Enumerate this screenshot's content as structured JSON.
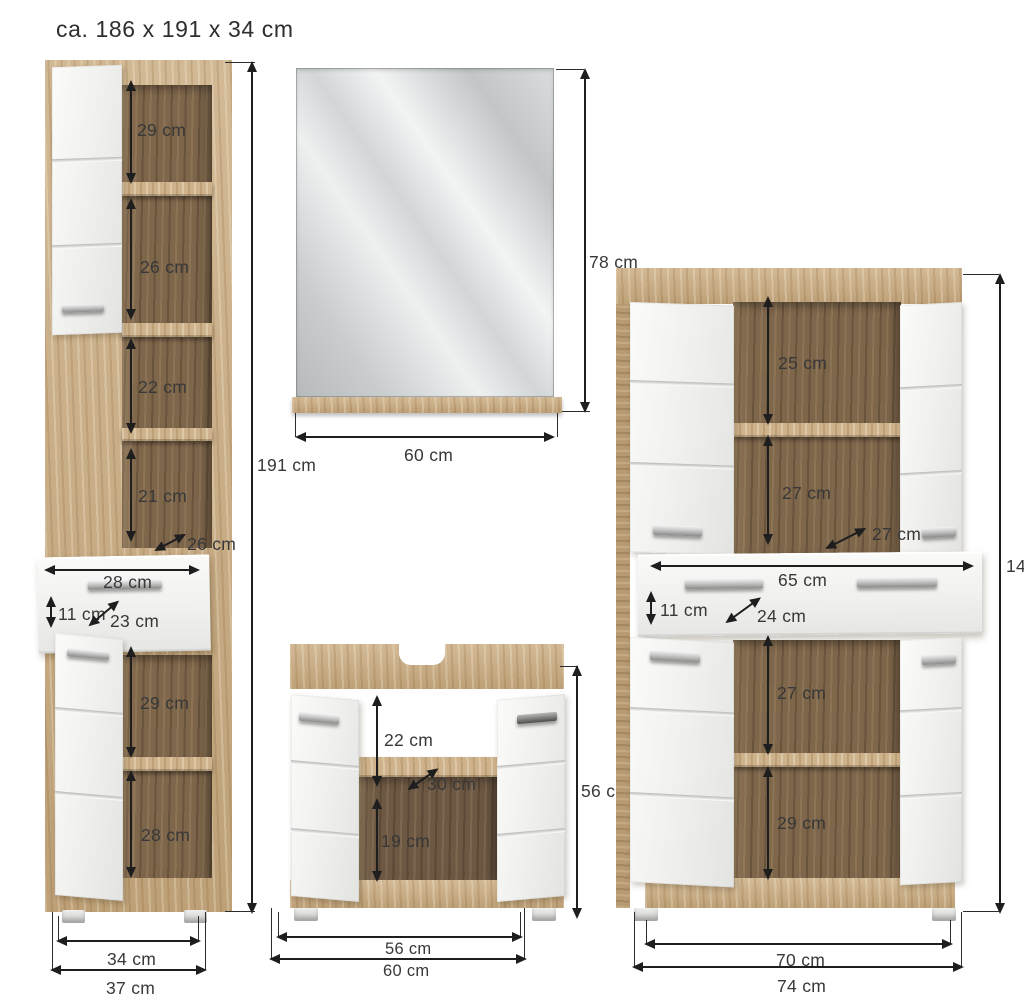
{
  "title": "ca. 186 x 191 x 34 cm",
  "colors": {
    "wood_light": "#cbae84",
    "wood_interior": "#7e664b",
    "front_white": "#f1f1ef",
    "mirror_glass": "#d2d6d7",
    "dimension_line": "#1e1e1e",
    "label_text": "#383838",
    "background": "#ffffff"
  },
  "tall_cabinet": {
    "height": "191 cm",
    "compartments": {
      "c1": "29 cm",
      "c2": "26 cm",
      "c3": "22 cm",
      "c4": "21 cm"
    },
    "depth": "26 cm",
    "drawer": {
      "width": "28 cm",
      "height": "11 cm",
      "depth": "23 cm"
    },
    "lower_compartments": {
      "c1": "29 cm",
      "c2": "28 cm"
    },
    "width_inner": "34 cm",
    "width_outer": "37 cm"
  },
  "mirror": {
    "height": "78 cm",
    "width": "60 cm"
  },
  "sink_cabinet": {
    "upper_compartment": "22 cm",
    "depth": "30 cm",
    "lower_compartment": "19 cm",
    "height": "56 cm",
    "width_inner": "56 cm",
    "width_outer": "60 cm"
  },
  "right_cabinet": {
    "height": "141",
    "compartments": {
      "c1": "25 cm",
      "c2": "27 cm"
    },
    "depth": "27 cm",
    "drawer": {
      "width": "65 cm",
      "height": "11 cm",
      "depth": "24 cm"
    },
    "lower_compartments": {
      "c1": "27 cm",
      "c2": "29 cm"
    },
    "width_inner": "70 cm",
    "width_outer": "74 cm"
  }
}
